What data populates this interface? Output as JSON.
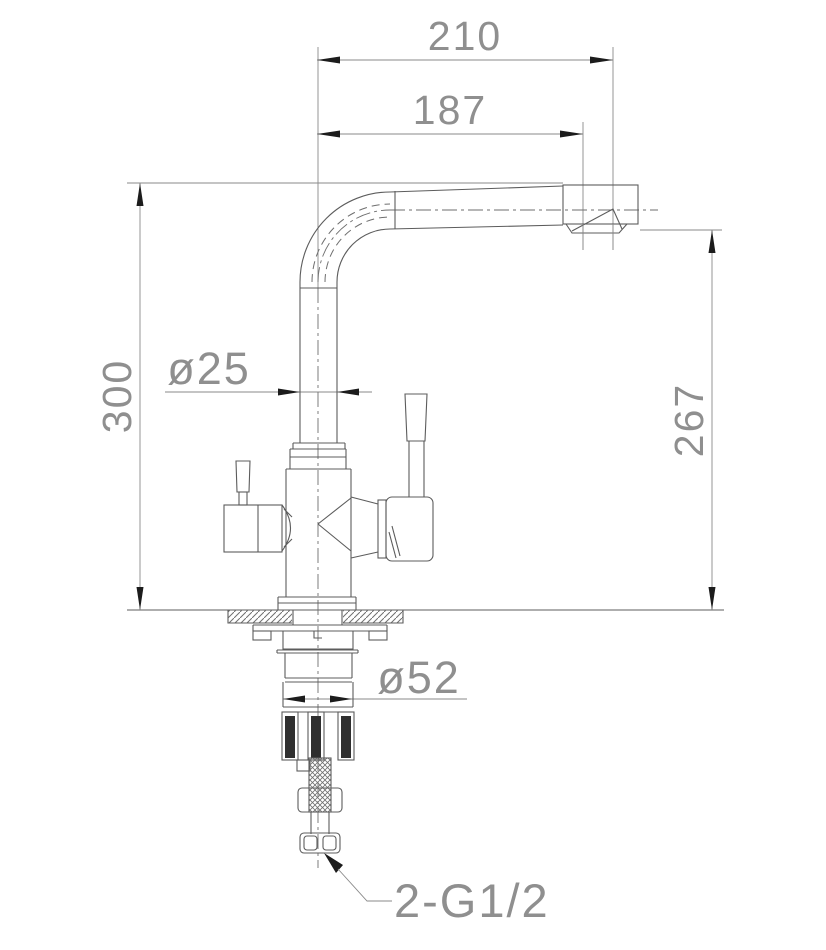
{
  "drawing": {
    "type": "technical-dimension-drawing",
    "subject": "kitchen-faucet-side-elevation",
    "labels": {
      "dim_total_width": "210",
      "dim_spout_reach": "187",
      "dim_total_height": "300",
      "dim_spout_height": "267",
      "dim_riser_diameter": "ø25",
      "dim_base_diameter": "ø52",
      "thread_callout": "2-G1/2"
    },
    "colors": {
      "background": "#ffffff",
      "object_line": "#5c5c5c",
      "dimension_line": "#8a8a8a",
      "arrow": "#1c1c1c",
      "label_text": "#8f8f8f"
    }
  }
}
